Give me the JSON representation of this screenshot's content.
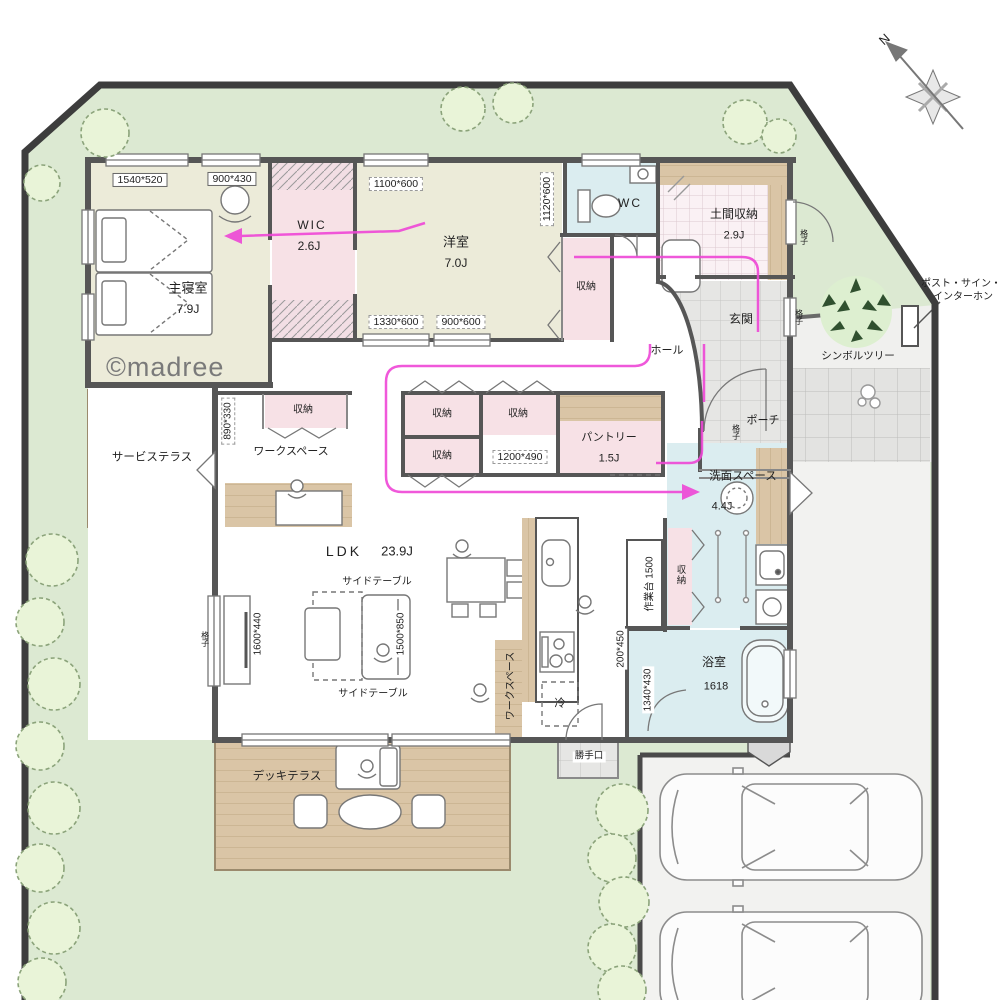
{
  "plan": {
    "watermark": "©madree",
    "compass_n": "N",
    "rooms": {
      "master_bedroom": {
        "name": "主寝室",
        "size": "7.9J"
      },
      "wic": {
        "name": "WIC",
        "size": "2.6J"
      },
      "western_room": {
        "name": "洋室",
        "size": "7.0J"
      },
      "wc": {
        "name": "WC"
      },
      "doma_storage": {
        "name": "土間収納",
        "size": "2.9J"
      },
      "genkan": {
        "name": "玄関"
      },
      "hall": {
        "name": "ホール"
      },
      "porch": {
        "name": "ポーチ"
      },
      "storage": {
        "name": "収納"
      },
      "pantry": {
        "name": "パントリー",
        "size": "1.5J"
      },
      "washroom": {
        "name": "洗面スペース",
        "size": "4.4J"
      },
      "bathroom": {
        "name": "浴室",
        "size": "1618"
      },
      "ldk": {
        "name": "LDK",
        "size": "23.9J"
      },
      "workspace": {
        "name": "ワークスペース"
      },
      "service_terrace": {
        "name": "サービステラス"
      },
      "deck_terrace": {
        "name": "デッキテラス"
      },
      "kitchen_back_door": {
        "name": "勝手口"
      },
      "refrigerator": {
        "name": "冷"
      },
      "work_counter": {
        "name": "作業台 1500"
      }
    },
    "furniture": {
      "side_table": "サイドテーブル"
    },
    "dims": {
      "d1540_520": "1540*520",
      "d900_430": "900*430",
      "d1100_600": "1100*600",
      "d1120_600": "1120*600",
      "d1330_600": "1330*600",
      "d900_600": "900*600",
      "d890_330": "890*330",
      "d1200_490": "1200*490",
      "d1600_440": "1600*440",
      "d1500_850": "1500*850",
      "d200_450": "200*450",
      "d1340_430": "1340*430"
    },
    "exterior": {
      "symbol_tree": "シンボルツリー",
      "post_sign_1": "ポスト・サイン・",
      "post_sign_2": "インターホン",
      "lattice": "格子"
    },
    "colors": {
      "lawn": "#dce9d2",
      "wall": "#565656",
      "room_cream": "#ecebd9",
      "room_pink": "#f7e1e6",
      "room_blue": "#dbedf0",
      "wood": "#d9c3a4",
      "tile": "#e6e6e4",
      "flow_arrow": "#ee46d6"
    }
  }
}
